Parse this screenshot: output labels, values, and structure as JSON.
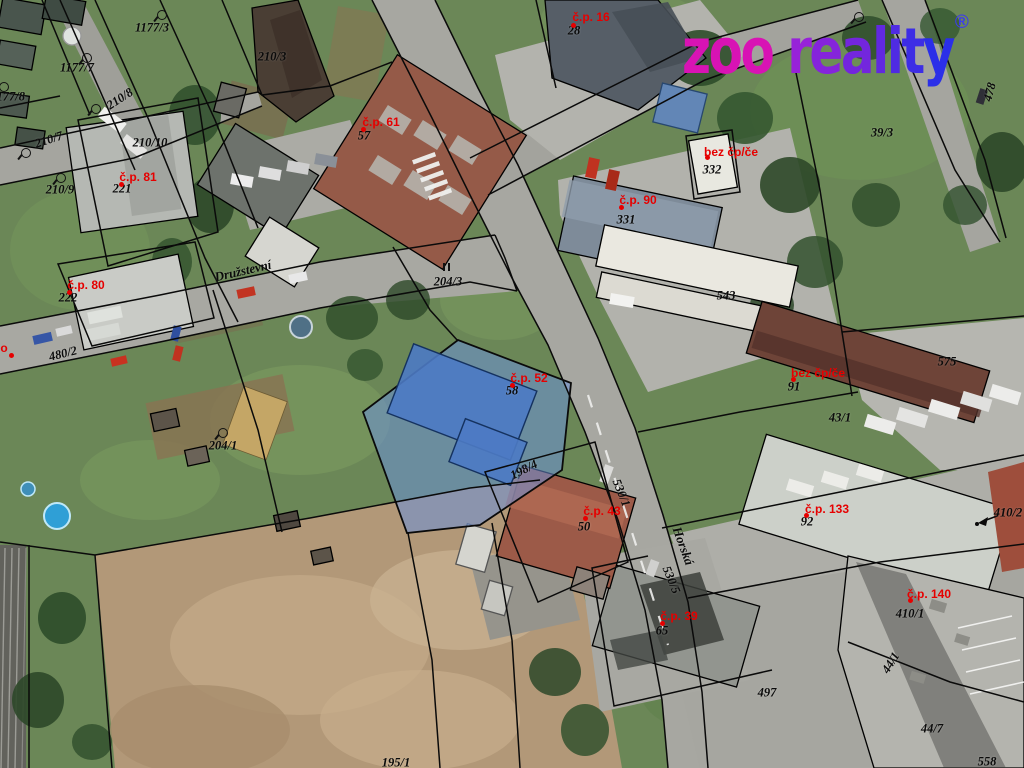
{
  "logo": {
    "zoo": "zoo ",
    "reality": "reality",
    "registered": "®",
    "zoo_color": "#d813b4",
    "reality_color_start": "#9722d8",
    "reality_color_end": "#2b2fe8",
    "registered_color": "#3d3de8"
  },
  "map": {
    "colors": {
      "parcel_label": "#0b0b0b",
      "house_label": "#e60000",
      "cadastral_line": "#0a0a0a",
      "highlight_fill": "#6b92d8",
      "highlight_building": "#4d7ac4"
    },
    "streets": [
      {
        "name": "Družstevní",
        "x": 243,
        "y": 271,
        "r": -13
      },
      {
        "name": "Horská",
        "x": 683,
        "y": 546,
        "r": 70
      }
    ],
    "parcel_labels": [
      {
        "text": "1177/3",
        "x": 152,
        "y": 28,
        "r": 0
      },
      {
        "text": "1177/7",
        "x": 77,
        "y": 68,
        "r": 0
      },
      {
        "text": "1177/8",
        "x": 8,
        "y": 97,
        "r": 0
      },
      {
        "text": "210/8",
        "x": 120,
        "y": 99,
        "r": -33
      },
      {
        "text": "210/3",
        "x": 272,
        "y": 57,
        "r": 0
      },
      {
        "text": "210/7",
        "x": 49,
        "y": 140,
        "r": -18
      },
      {
        "text": "210/10",
        "x": 150,
        "y": 143,
        "r": 0
      },
      {
        "text": "210/9",
        "x": 60,
        "y": 190,
        "r": 0
      },
      {
        "text": "221",
        "x": 122,
        "y": 189,
        "r": 0
      },
      {
        "text": "222",
        "x": 68,
        "y": 298,
        "r": 0
      },
      {
        "text": "480/2",
        "x": 63,
        "y": 354,
        "r": -14
      },
      {
        "text": "204/3",
        "x": 448,
        "y": 282,
        "r": 0
      },
      {
        "text": "204/1",
        "x": 223,
        "y": 446,
        "r": 0
      },
      {
        "text": "28",
        "x": 574,
        "y": 31,
        "r": 0
      },
      {
        "text": "57",
        "x": 364,
        "y": 136,
        "r": 0
      },
      {
        "text": "331",
        "x": 626,
        "y": 220,
        "r": 0
      },
      {
        "text": "332",
        "x": 712,
        "y": 170,
        "r": 0
      },
      {
        "text": "543",
        "x": 726,
        "y": 296,
        "r": 0
      },
      {
        "text": "575",
        "x": 947,
        "y": 362,
        "r": 0
      },
      {
        "text": "39/3",
        "x": 882,
        "y": 133,
        "r": 0
      },
      {
        "text": "478",
        "x": 990,
        "y": 92,
        "r": -75
      },
      {
        "text": "43/1",
        "x": 840,
        "y": 418,
        "r": 0
      },
      {
        "text": "91",
        "x": 794,
        "y": 387,
        "r": 0
      },
      {
        "text": "92",
        "x": 807,
        "y": 522,
        "r": 0
      },
      {
        "text": "58",
        "x": 512,
        "y": 391,
        "r": 0
      },
      {
        "text": "198/4",
        "x": 524,
        "y": 470,
        "r": -27
      },
      {
        "text": "530/1",
        "x": 621,
        "y": 493,
        "r": 68
      },
      {
        "text": "530/5",
        "x": 671,
        "y": 580,
        "r": 68
      },
      {
        "text": "50",
        "x": 584,
        "y": 527,
        "r": 0
      },
      {
        "text": "65",
        "x": 662,
        "y": 631,
        "r": 0
      },
      {
        "text": "497",
        "x": 767,
        "y": 693,
        "r": 0
      },
      {
        "text": "410/1",
        "x": 910,
        "y": 614,
        "r": 0
      },
      {
        "text": "410/2",
        "x": 1008,
        "y": 513,
        "r": 0
      },
      {
        "text": "44/1",
        "x": 891,
        "y": 663,
        "r": -58
      },
      {
        "text": "44/7",
        "x": 932,
        "y": 729,
        "r": 0
      },
      {
        "text": "558",
        "x": 987,
        "y": 762,
        "r": 0
      },
      {
        "text": "195/1",
        "x": 396,
        "y": 763,
        "r": 0
      }
    ],
    "house_labels": [
      {
        "text": "č.p. 16",
        "x": 591,
        "y": 17,
        "dot_x": 573,
        "dot_y": 25
      },
      {
        "text": "č.p. 61",
        "x": 381,
        "y": 122,
        "dot_x": 363,
        "dot_y": 129
      },
      {
        "text": "č.p. 81",
        "x": 138,
        "y": 177,
        "dot_x": 121,
        "dot_y": 184
      },
      {
        "text": "č.p. 80",
        "x": 86,
        "y": 285,
        "dot_x": 69,
        "dot_y": 292
      },
      {
        "text": "č.p. 90",
        "x": 638,
        "y": 200,
        "dot_x": 621,
        "dot_y": 207
      },
      {
        "text": "bez čp/če",
        "x": 731,
        "y": 152,
        "dot_x": 707,
        "dot_y": 157
      },
      {
        "text": "č.p. 52",
        "x": 529,
        "y": 378,
        "dot_x": 512,
        "dot_y": 385
      },
      {
        "text": "č.p. 43",
        "x": 602,
        "y": 511,
        "dot_x": 585,
        "dot_y": 518
      },
      {
        "text": "bez čp/če",
        "x": 818,
        "y": 373,
        "dot_x": 793,
        "dot_y": 379
      },
      {
        "text": "č.p. 133",
        "x": 827,
        "y": 509,
        "dot_x": 806,
        "dot_y": 515
      },
      {
        "text": "č.p. 140",
        "x": 929,
        "y": 594,
        "dot_x": 910,
        "dot_y": 600
      },
      {
        "text": "č.p. 39",
        "x": 679,
        "y": 616,
        "dot_x": 662,
        "dot_y": 623
      }
    ],
    "label_fragment": {
      "text": "o",
      "x": 4,
      "y": 348,
      "dot_x": 11,
      "dot_y": 355
    },
    "landuse_symbols": [
      {
        "x": 161,
        "y": 14
      },
      {
        "x": 86,
        "y": 57
      },
      {
        "x": 3,
        "y": 86
      },
      {
        "x": 95,
        "y": 108
      },
      {
        "x": 25,
        "y": 152
      },
      {
        "x": 60,
        "y": 177
      },
      {
        "x": 222,
        "y": 432
      },
      {
        "x": 858,
        "y": 16
      }
    ],
    "double_mark": {
      "x": 447,
      "y": 267
    }
  }
}
